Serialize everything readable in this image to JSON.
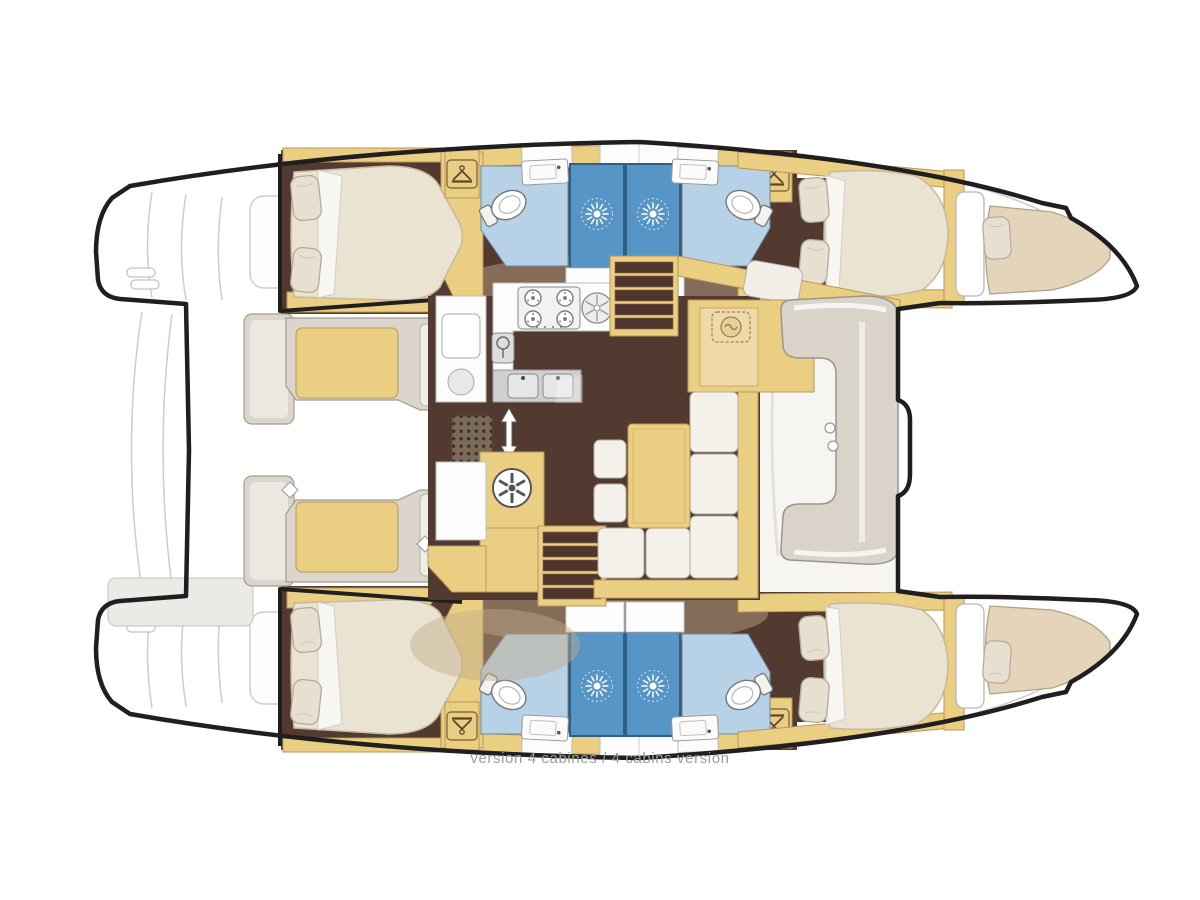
{
  "caption": "version 4 cabines / 4 cabins version",
  "plan": {
    "type": "boat-floor-plan",
    "vessel": "catamaran",
    "cabins_shown": 4,
    "features": [
      "wardrobe-hanger-icon",
      "shower-sunburst-icon",
      "toilet-icon",
      "bathroom-sink-icon",
      "stove-4-burner-icon",
      "round-sink-icon",
      "double-sink-icon",
      "fridge-icon",
      "companionway-stairs-icon",
      "up-down-arrow-icon",
      "vent-grate-icon",
      "fan-wheel-icon",
      "nav-locker-icon",
      "dinette-table",
      "c-shaped-lounge",
      "aft-cockpit-benches",
      "stern-steps",
      "forepeak-berths"
    ]
  },
  "colors": {
    "outline": "#1f1f1f",
    "wood_tan": "#eace82",
    "wood_tan_stroke": "#b8965a",
    "floor_brown": "#523a31",
    "overlay_beige": "#c2ab8a",
    "bathroom_blue": "#b7d2e6",
    "shower_blue": "#5795c7",
    "mattress_cream": "#eae3d2",
    "bench_gray": "#dbd5cb",
    "deck_white": "#ffffff",
    "caption_gray": "#9b9b9b"
  }
}
